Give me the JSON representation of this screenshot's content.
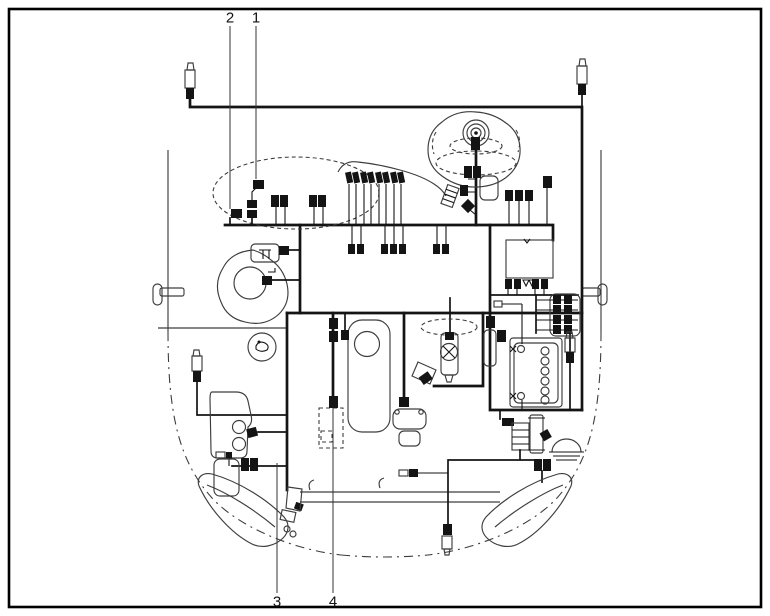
{
  "callouts": {
    "c1": "1",
    "c2": "2",
    "c3": "3",
    "c4": "4"
  },
  "colors": {
    "background": "#ffffff",
    "harness_line": "#141414",
    "component_outline": "#3d3d3d",
    "frame_border": "#000000"
  },
  "components": [
    "engine-wiring-harness",
    "intake-manifold",
    "fuel-injector-connectors",
    "air-cleaner",
    "blower-motor",
    "fuse-relay-box",
    "battery",
    "valve-cover",
    "distributor",
    "thermostat-housing",
    "coolant-reservoir",
    "washer-bottle",
    "left-headlight",
    "right-headlight",
    "horn",
    "front-bumper-beam",
    "car-body-outline"
  ]
}
